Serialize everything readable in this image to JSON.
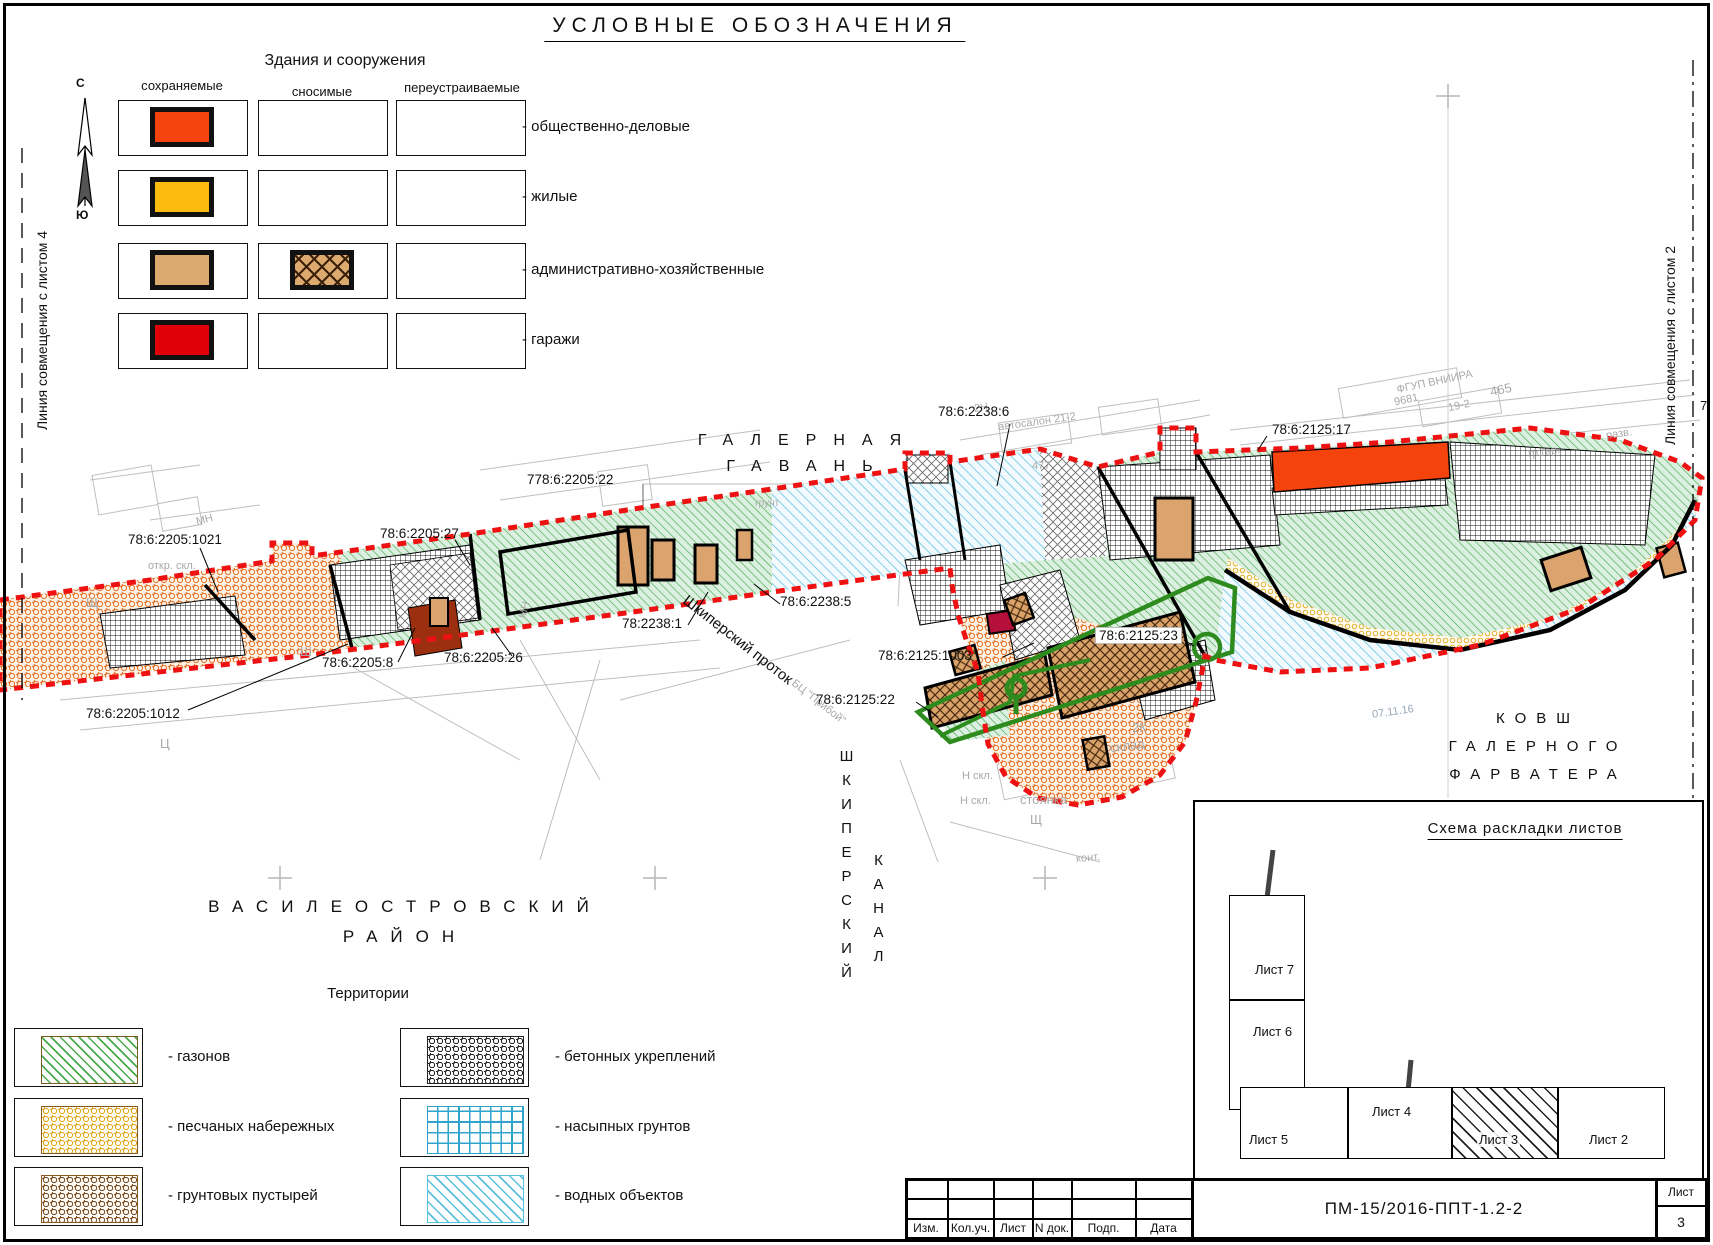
{
  "page_title": "УСЛОВНЫЕ  ОБОЗНАЧЕНИЯ",
  "compass": {
    "north": "С",
    "south": "Ю"
  },
  "match_lines": {
    "left": "Линия совмещения с листом 4",
    "right": "Линия совмещения с листом 2",
    "right_edge_number": "7"
  },
  "legend_buildings": {
    "title": "Здания и сооружения",
    "columns": [
      "сохраняемые",
      "сносимые",
      "переустраиваемые"
    ],
    "rows": [
      {
        "label": "- общественно-деловые",
        "color": "#f5430d"
      },
      {
        "label": "- жилые",
        "color": "#fdbb0e"
      },
      {
        "label": "- административно-хозяйственные",
        "color": "#dca96e"
      },
      {
        "label": "- гаражи",
        "color": "#df0008"
      }
    ]
  },
  "legend_territories": {
    "title": "Территории",
    "left": [
      {
        "label": "- газонов",
        "pattern": "green-hatch"
      },
      {
        "label": "- песчаных набережных",
        "pattern": "yellow-honeycomb"
      },
      {
        "label": "- грунтовых пустырей",
        "pattern": "brown-honeycomb"
      }
    ],
    "right": [
      {
        "label": "- бетонных укреплений",
        "pattern": "black-honeycomb"
      },
      {
        "label": "- насыпных грунтов",
        "pattern": "blue-grid"
      },
      {
        "label": "- водных объектов",
        "pattern": "cyan-hatch"
      }
    ]
  },
  "district": {
    "line1": "ВАСИЛЕОСТРОВСКИЙ",
    "line2": "РАЙОН"
  },
  "map": {
    "galernaya": {
      "line1": "ГАЛЕРНАЯ",
      "line2": "ГАВАНЬ"
    },
    "kovsh": {
      "line1": "КОВШ",
      "line2": "ГАЛЕРНОГО",
      "line3": "ФАРВАТЕРА"
    },
    "protok": "Шкиперский проток",
    "kanal": {
      "col1": "ШКИПЕРСКИЙ",
      "col2": "КАНАЛ"
    },
    "boundary_color": "#ee1111",
    "project_outline_color": "#2e8b1e",
    "cadastral": [
      {
        "id": "778:6:2205:22"
      },
      {
        "id": "78:6:2205:1021"
      },
      {
        "id": "78:6:2205:1012"
      },
      {
        "id": "78:6:2205:8"
      },
      {
        "id": "78:6:2205:26"
      },
      {
        "id": "78:6:2205:27"
      },
      {
        "id": "78:2238:1"
      },
      {
        "id": "78:6:2238:5"
      },
      {
        "id": "78:6:2238:6"
      },
      {
        "id": "78:6:2125:17"
      },
      {
        "id": "78:6:2125:23"
      },
      {
        "id": "78:6:2125:1003"
      },
      {
        "id": "78:6:2125:22"
      }
    ],
    "grey_texts": [
      {
        "t": "откр. скл."
      },
      {
        "t": "МН"
      },
      {
        "t": "МН"
      },
      {
        "t": "Щ"
      },
      {
        "t": "Ц"
      },
      {
        "t": "Ш"
      },
      {
        "t": "грунт"
      },
      {
        "t": "автосалон 21-2"
      },
      {
        "t": "2Н"
      },
      {
        "t": "477"
      },
      {
        "t": "ФГУП ВНИИРА"
      },
      {
        "t": "9681"
      },
      {
        "t": "465"
      },
      {
        "t": "19-2"
      },
      {
        "t": "разв."
      },
      {
        "t": "гр.гар."
      },
      {
        "t": "2К"
      },
      {
        "t": "склад"
      },
      {
        "t": "стоянка"
      },
      {
        "t": "Щ"
      },
      {
        "t": "Н скл."
      },
      {
        "t": "Н скл."
      },
      {
        "t": "конт."
      },
      {
        "t": "БЦ \"Прибой\""
      }
    ],
    "date_note": "07.11.16"
  },
  "sheet_scheme": {
    "title": "Схема раскладки листов",
    "sheets": [
      {
        "label": "Лист 7"
      },
      {
        "label": "Лист 6"
      },
      {
        "label": "Лист 5"
      },
      {
        "label": "Лист 4"
      },
      {
        "label": "Лист 3"
      },
      {
        "label": "Лист 2"
      }
    ],
    "current": "Лист 3"
  },
  "title_block": {
    "columns": [
      "Изм.",
      "Кол.уч.",
      "Лист",
      "N док.",
      "Подп.",
      "Дата"
    ],
    "doc_number": "ПМ-15/2016-ППТ-1.2-2",
    "sheet_label": "Лист",
    "sheet_number": "3"
  }
}
